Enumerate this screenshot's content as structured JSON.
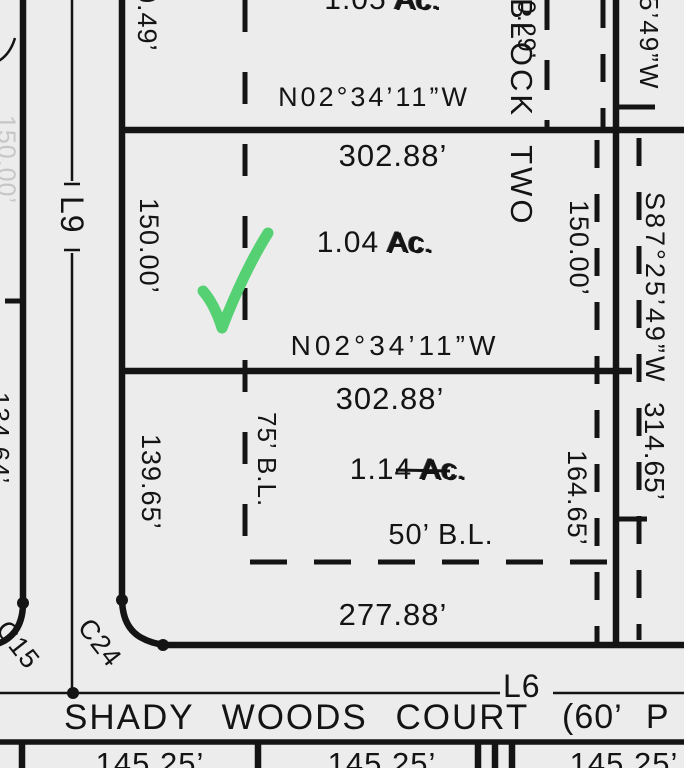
{
  "colors": {
    "ink": "#141414",
    "paper": "#ececec",
    "faint_text": "#c6c6c6"
  },
  "annotation": {
    "checkmark_color": "#55d174"
  },
  "block": {
    "label": "BLOCK TWO"
  },
  "street": {
    "name": "SHADY WOODS COURT",
    "row_note": "(60’ P",
    "centerline_label": "L6"
  },
  "west_street": {
    "centerline_label": "L9",
    "curve_label_west": "C15",
    "curve_label_east": "C24",
    "faint_dim": "150.00’",
    "edge_partial_dim": "134.64’"
  },
  "lots": {
    "top": {
      "area_value": "1.05",
      "area_unit": "Ac.",
      "bearing": "N02°34’11”W",
      "west_dim": "0.49’",
      "east_dim": "0.29’"
    },
    "middle": {
      "frontage": "302.88’",
      "area_value": "1.04",
      "area_unit": "Ac.",
      "bearing": "N02°34’11”W",
      "west_dim": "150.00’",
      "east_dim": "150.00’"
    },
    "bottom": {
      "frontage": "302.88’",
      "area_value": "1.14",
      "area_unit": "Ac.",
      "west_dim": "139.65’",
      "east_dim": "164.65’",
      "rear_dim": "277.88’",
      "building_line_75": "75’ B.L.",
      "building_line_50": "50’  B.L."
    }
  },
  "east_line": {
    "bearing_partial_top": "5’49”W",
    "bearing": "S87°25’49”W",
    "distance": "314.65’"
  },
  "south_lots": {
    "frontage_1": "145.25’",
    "frontage_2": "145.25’",
    "frontage_3": "145.25’"
  }
}
